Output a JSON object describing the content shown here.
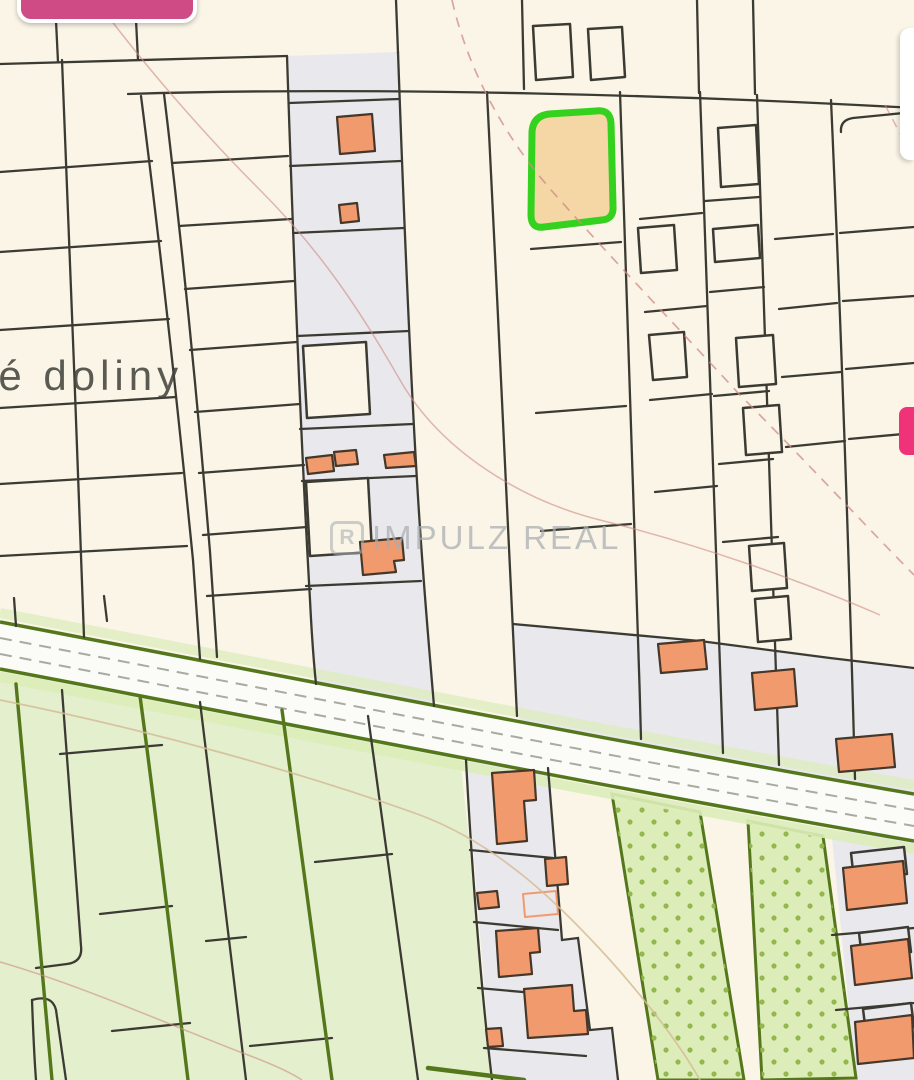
{
  "map": {
    "area_label": "né doliny",
    "watermark": {
      "logo_letter": "R",
      "text": "IMPULZ REAL"
    },
    "highlighted_parcel": {
      "status": "selected-listing-parcel"
    }
  },
  "colors": {
    "cream": "#faf5e6",
    "parcel_gray": "#e9e9ed",
    "line_dark": "#3c3b33",
    "green_fill": "#e3efcd",
    "orchard_fill": "#dcedb9",
    "dot_green": "#93b84d",
    "green_border": "#55771c",
    "road_white": "#fbfbf8",
    "road_dash": "#a8ab9f",
    "highlight_green": "#35d11f",
    "highlight_fill": "#f4d7a5",
    "building_orange": "#f09a6d",
    "building_outline": "#453729",
    "contour_red": "#cf8b85",
    "contour_tan": "#d6bb97",
    "watermark_gray": "#a9adb2",
    "ui_pink": "#cf4b86",
    "ui_pink_bright": "#f03378",
    "text_dark": "#45453f"
  }
}
